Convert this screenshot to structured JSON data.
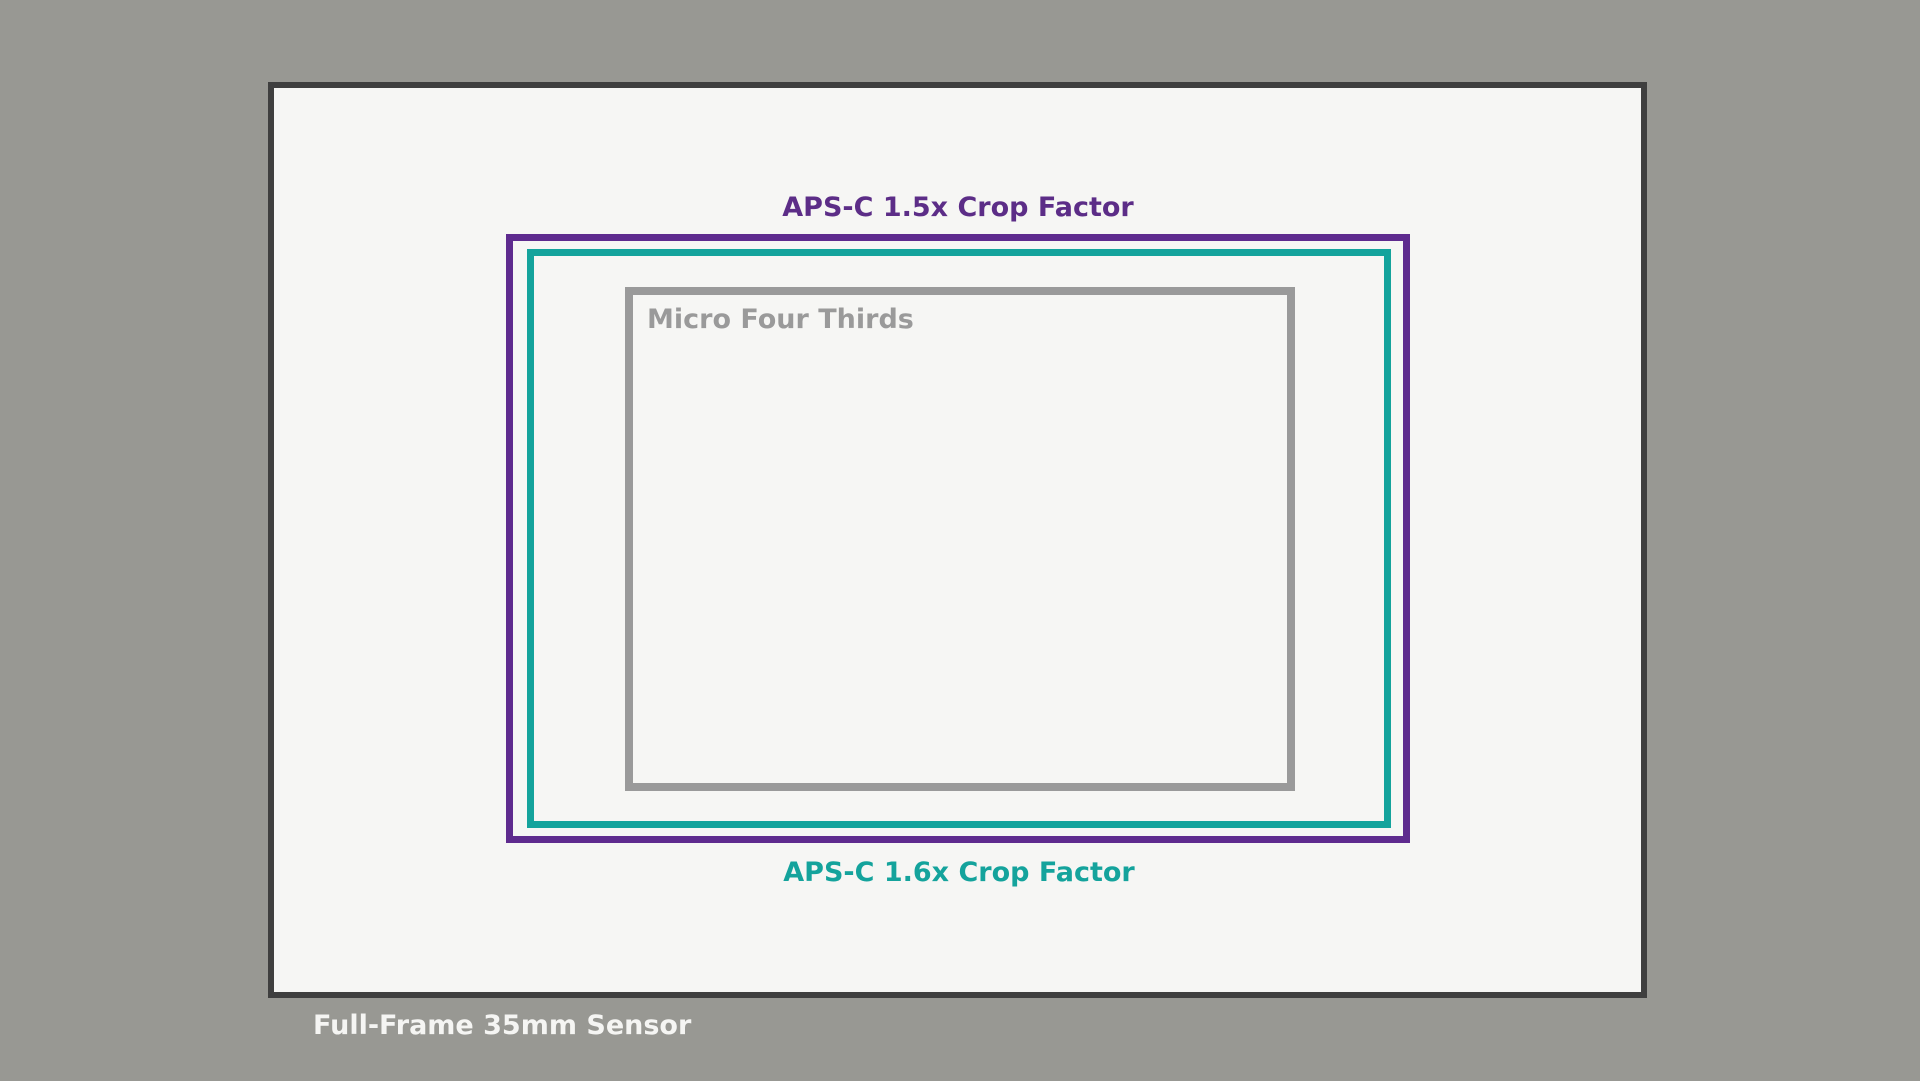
{
  "diagram": {
    "title_hint": "camera-sensor-size-comparison",
    "background_color": "#989893",
    "canvas_fill": "#f6f6f4",
    "full_frame": {
      "label": "Full-Frame 35mm Sensor",
      "border_color": "#3f3f3f",
      "fill_color": "#f6f6f4",
      "label_color": "#f5f5f3"
    },
    "apsc_15x": {
      "label": "APS-C 1.5x Crop Factor",
      "border_color": "#5e2b8e",
      "label_color": "#5c2d87"
    },
    "apsc_16x": {
      "label": "APS-C 1.6x Crop Factor",
      "border_color": "#14a39c",
      "label_color": "#14a39c"
    },
    "micro_four_thirds": {
      "label": "Micro Four Thirds",
      "border_color": "#9a9a9a",
      "label_color": "#9a9a9a"
    }
  }
}
